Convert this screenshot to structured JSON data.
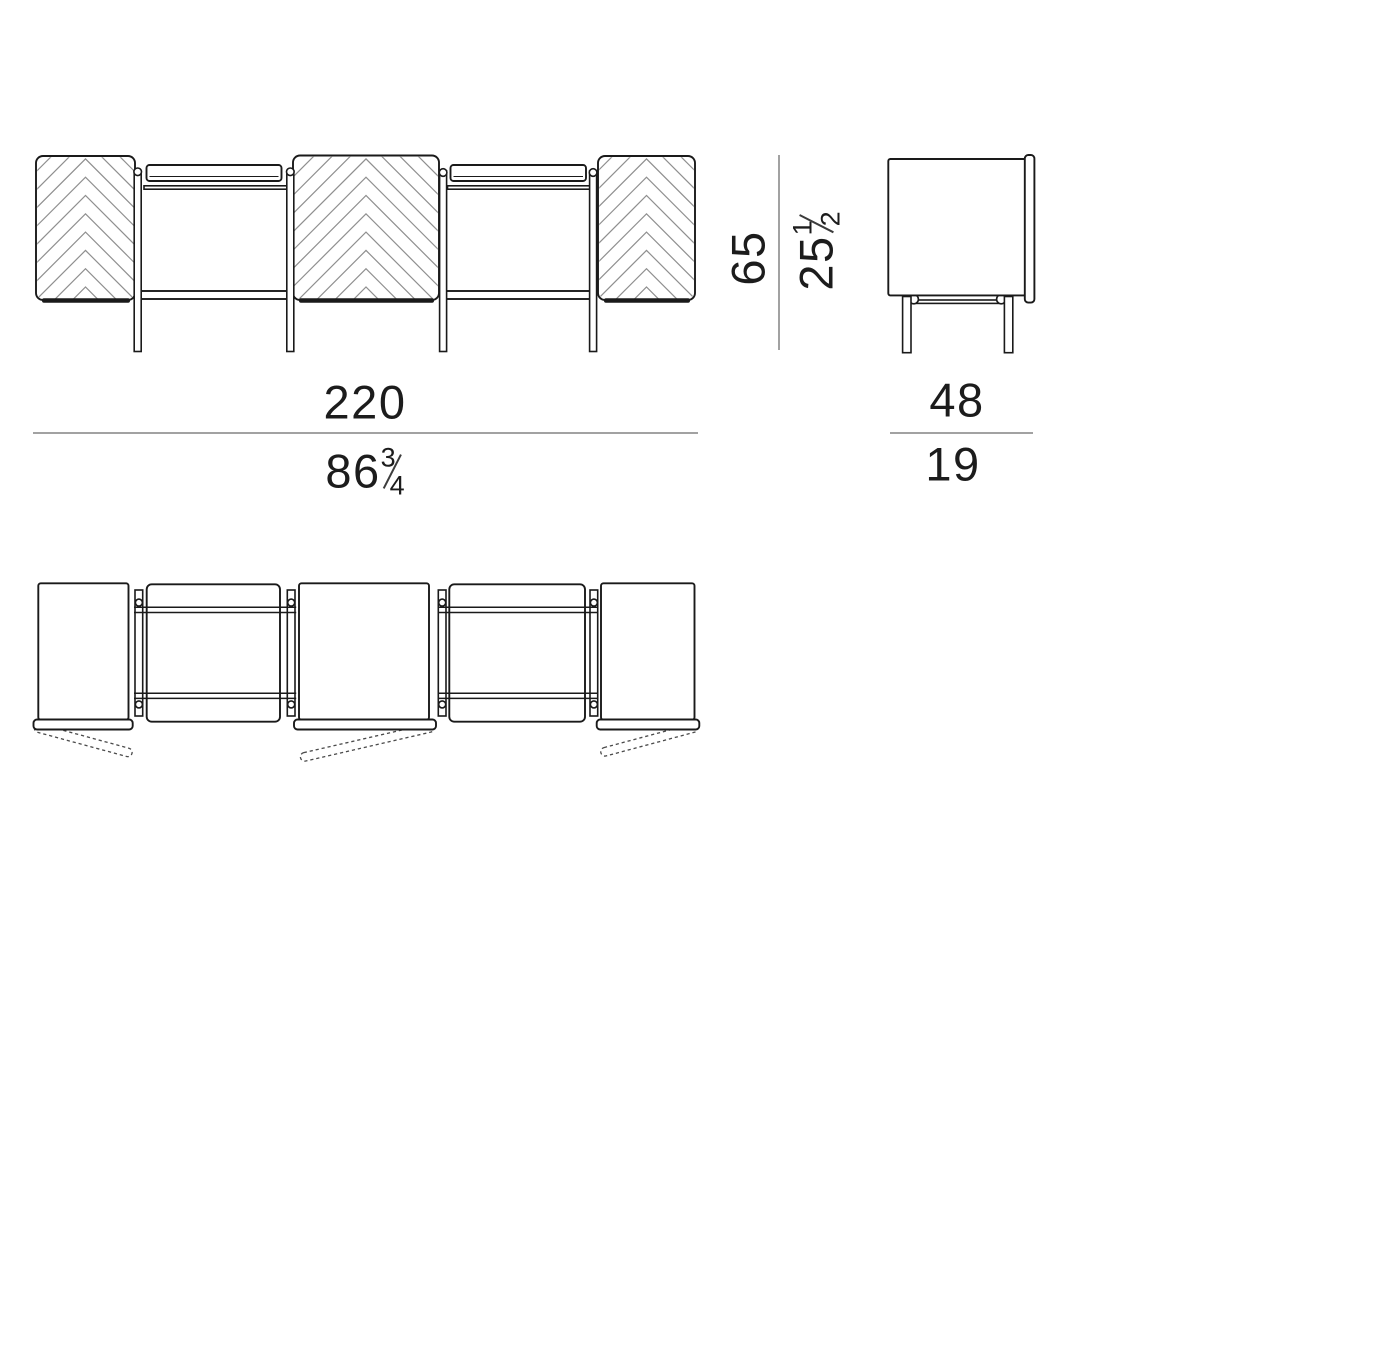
{
  "dimensions": {
    "width": {
      "cm": "220",
      "inch_whole": "86",
      "inch_numerator": "3",
      "inch_denominator": "4"
    },
    "height": {
      "cm": "65",
      "inch_whole": "25",
      "inch_numerator": "1",
      "inch_denominator": "2"
    },
    "depth": {
      "cm": "48",
      "inch_whole": "19"
    }
  }
}
